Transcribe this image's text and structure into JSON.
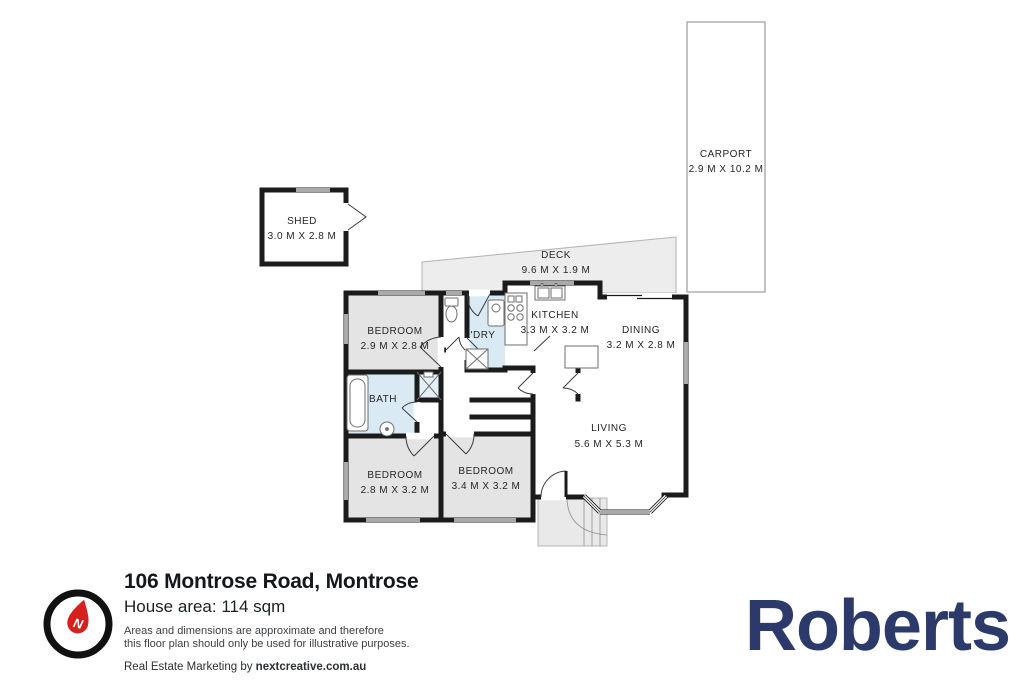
{
  "rooms": {
    "shed": {
      "name": "SHED",
      "dims": "3.0 M X 2.8 M"
    },
    "carport": {
      "name": "CARPORT",
      "dims": "2.9 M X 10.2 M"
    },
    "deck": {
      "name": "DECK",
      "dims": "9.6 M X 1.9 M"
    },
    "bedroom1": {
      "name": "BEDROOM",
      "dims": "2.9 M X 2.8 M"
    },
    "ldry": {
      "name": "L'DRY"
    },
    "kitchen": {
      "name": "KITCHEN",
      "dims": "3.3 M X 3.2 M"
    },
    "dining": {
      "name": "DINING",
      "dims": "3.2 M X 2.8 M"
    },
    "bath": {
      "name": "BATH"
    },
    "bedroom2": {
      "name": "BEDROOM",
      "dims": "2.8 M X 3.2 M"
    },
    "bedroom3": {
      "name": "BEDROOM",
      "dims": "3.4 M X 3.2 M"
    },
    "living": {
      "name": "LIVING",
      "dims": "5.6 M X 5.3 M"
    }
  },
  "footer": {
    "address": "106 Montrose Road, Montrose",
    "area": "House area: 114 sqm",
    "disclaimer1": "Areas and dimensions are approximate and therefore",
    "disclaimer2": "this floor plan should only be used for illustrative purposes.",
    "credit_prefix": "Real Estate Marketing by ",
    "credit_brand": "nextcreative.com.au",
    "compass_letter": "N"
  },
  "brand": {
    "logo_text": "Roberts"
  },
  "colors": {
    "wall": "#1b1b1b",
    "room_gray": "#e4e4e4",
    "wet_blue": "#d9eaf4",
    "deck_gray": "#ededed",
    "porch_gray": "#e9e9e9",
    "brand_navy": "#2b3a6a",
    "compass_red": "#d6201f"
  }
}
